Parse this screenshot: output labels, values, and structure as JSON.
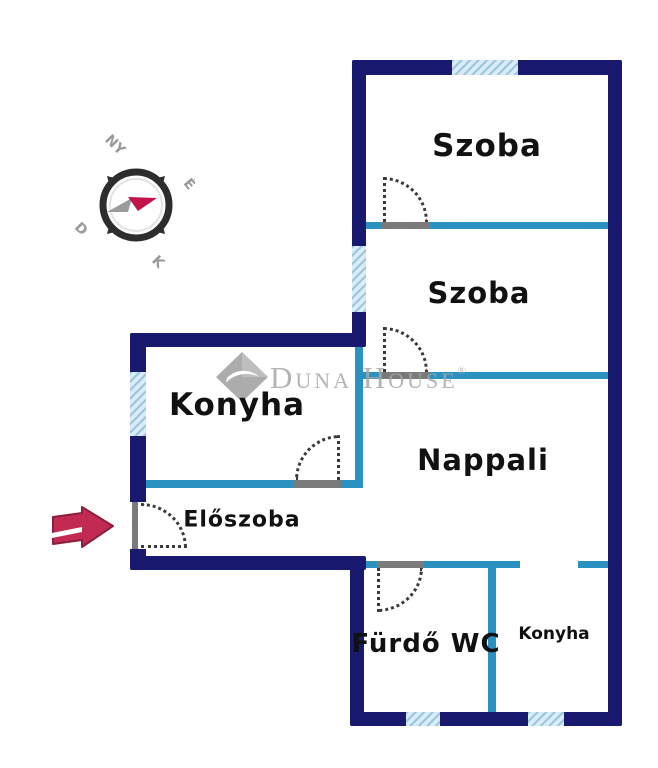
{
  "plan": {
    "rooms": [
      {
        "id": "szoba-1",
        "label": "Szoba"
      },
      {
        "id": "szoba-2",
        "label": "Szoba"
      },
      {
        "id": "konyha",
        "label": "Konyha"
      },
      {
        "id": "nappali",
        "label": "Nappali"
      },
      {
        "id": "eloszoba",
        "label": "Előszoba"
      },
      {
        "id": "furdo-wc",
        "label": "Fürdő WC"
      },
      {
        "id": "konyha-2",
        "label": "Konyha"
      }
    ]
  },
  "compass": {
    "north": "É",
    "west": "NY",
    "south": "D",
    "east": "K"
  },
  "watermark": {
    "brand": "Duna House",
    "registered": "®"
  },
  "colors": {
    "wall-outer": "#191970",
    "wall-inner": "#2a91c0",
    "window-fill": "#d9ecf7",
    "window-stripe": "#9cc5de",
    "threshold": "#7a7a7a",
    "door-arc": "#3a3a3a",
    "arrow": "#c22a52",
    "arrow-outline": "#8c1f3f",
    "watermark": "#a8a8a8",
    "label": "#111111",
    "compass-dark": "#2d2d2d",
    "compass-gray": "#9a9a9a",
    "needle-red": "#c2134b",
    "needle-gray": "#9b9b9b",
    "canvas": "#ffffff"
  }
}
